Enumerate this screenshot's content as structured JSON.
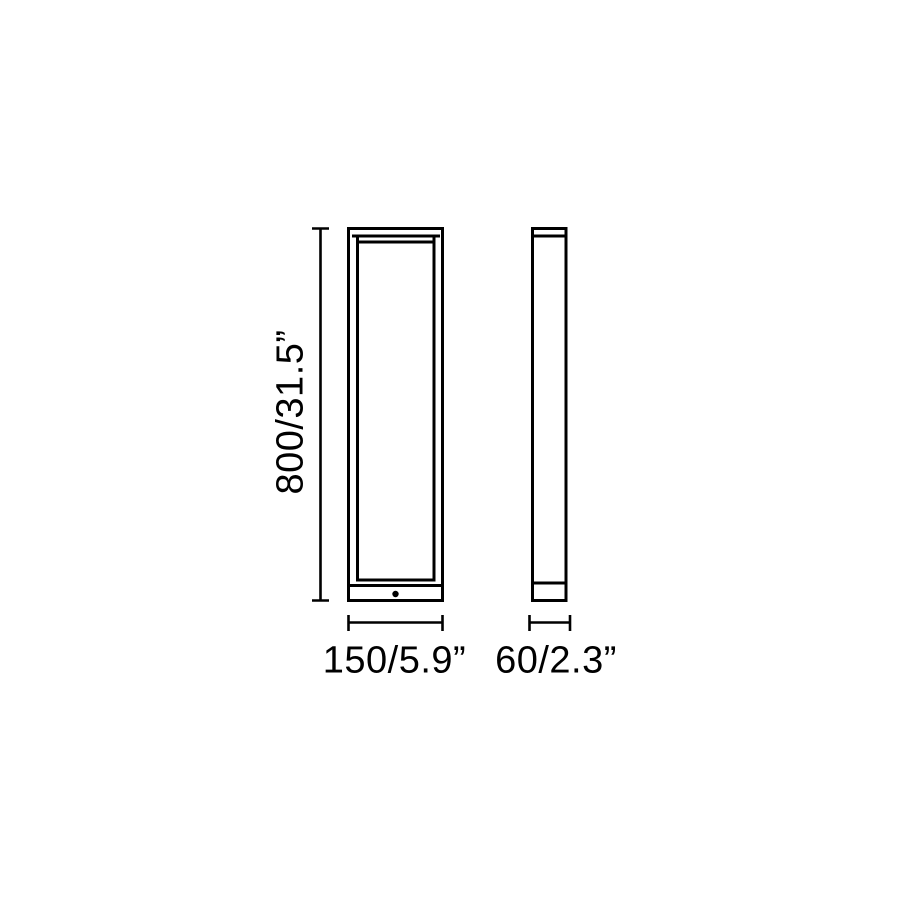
{
  "page": {
    "background_color": "#ffffff",
    "line_color": "#000000"
  },
  "diagram": {
    "type": "technical dimension drawing",
    "views": {
      "front": {
        "name": "front elevation"
      },
      "side": {
        "name": "side elevation"
      }
    },
    "dimensions": {
      "height": {
        "label": "800/31.5”",
        "millimeters": "800",
        "inches": "31.5"
      },
      "width": {
        "label": "150/5.9”",
        "millimeters": "150",
        "inches": "5.9"
      },
      "depth": {
        "label": "60/2.3”",
        "millimeters": "60",
        "inches": "2.3"
      }
    }
  }
}
